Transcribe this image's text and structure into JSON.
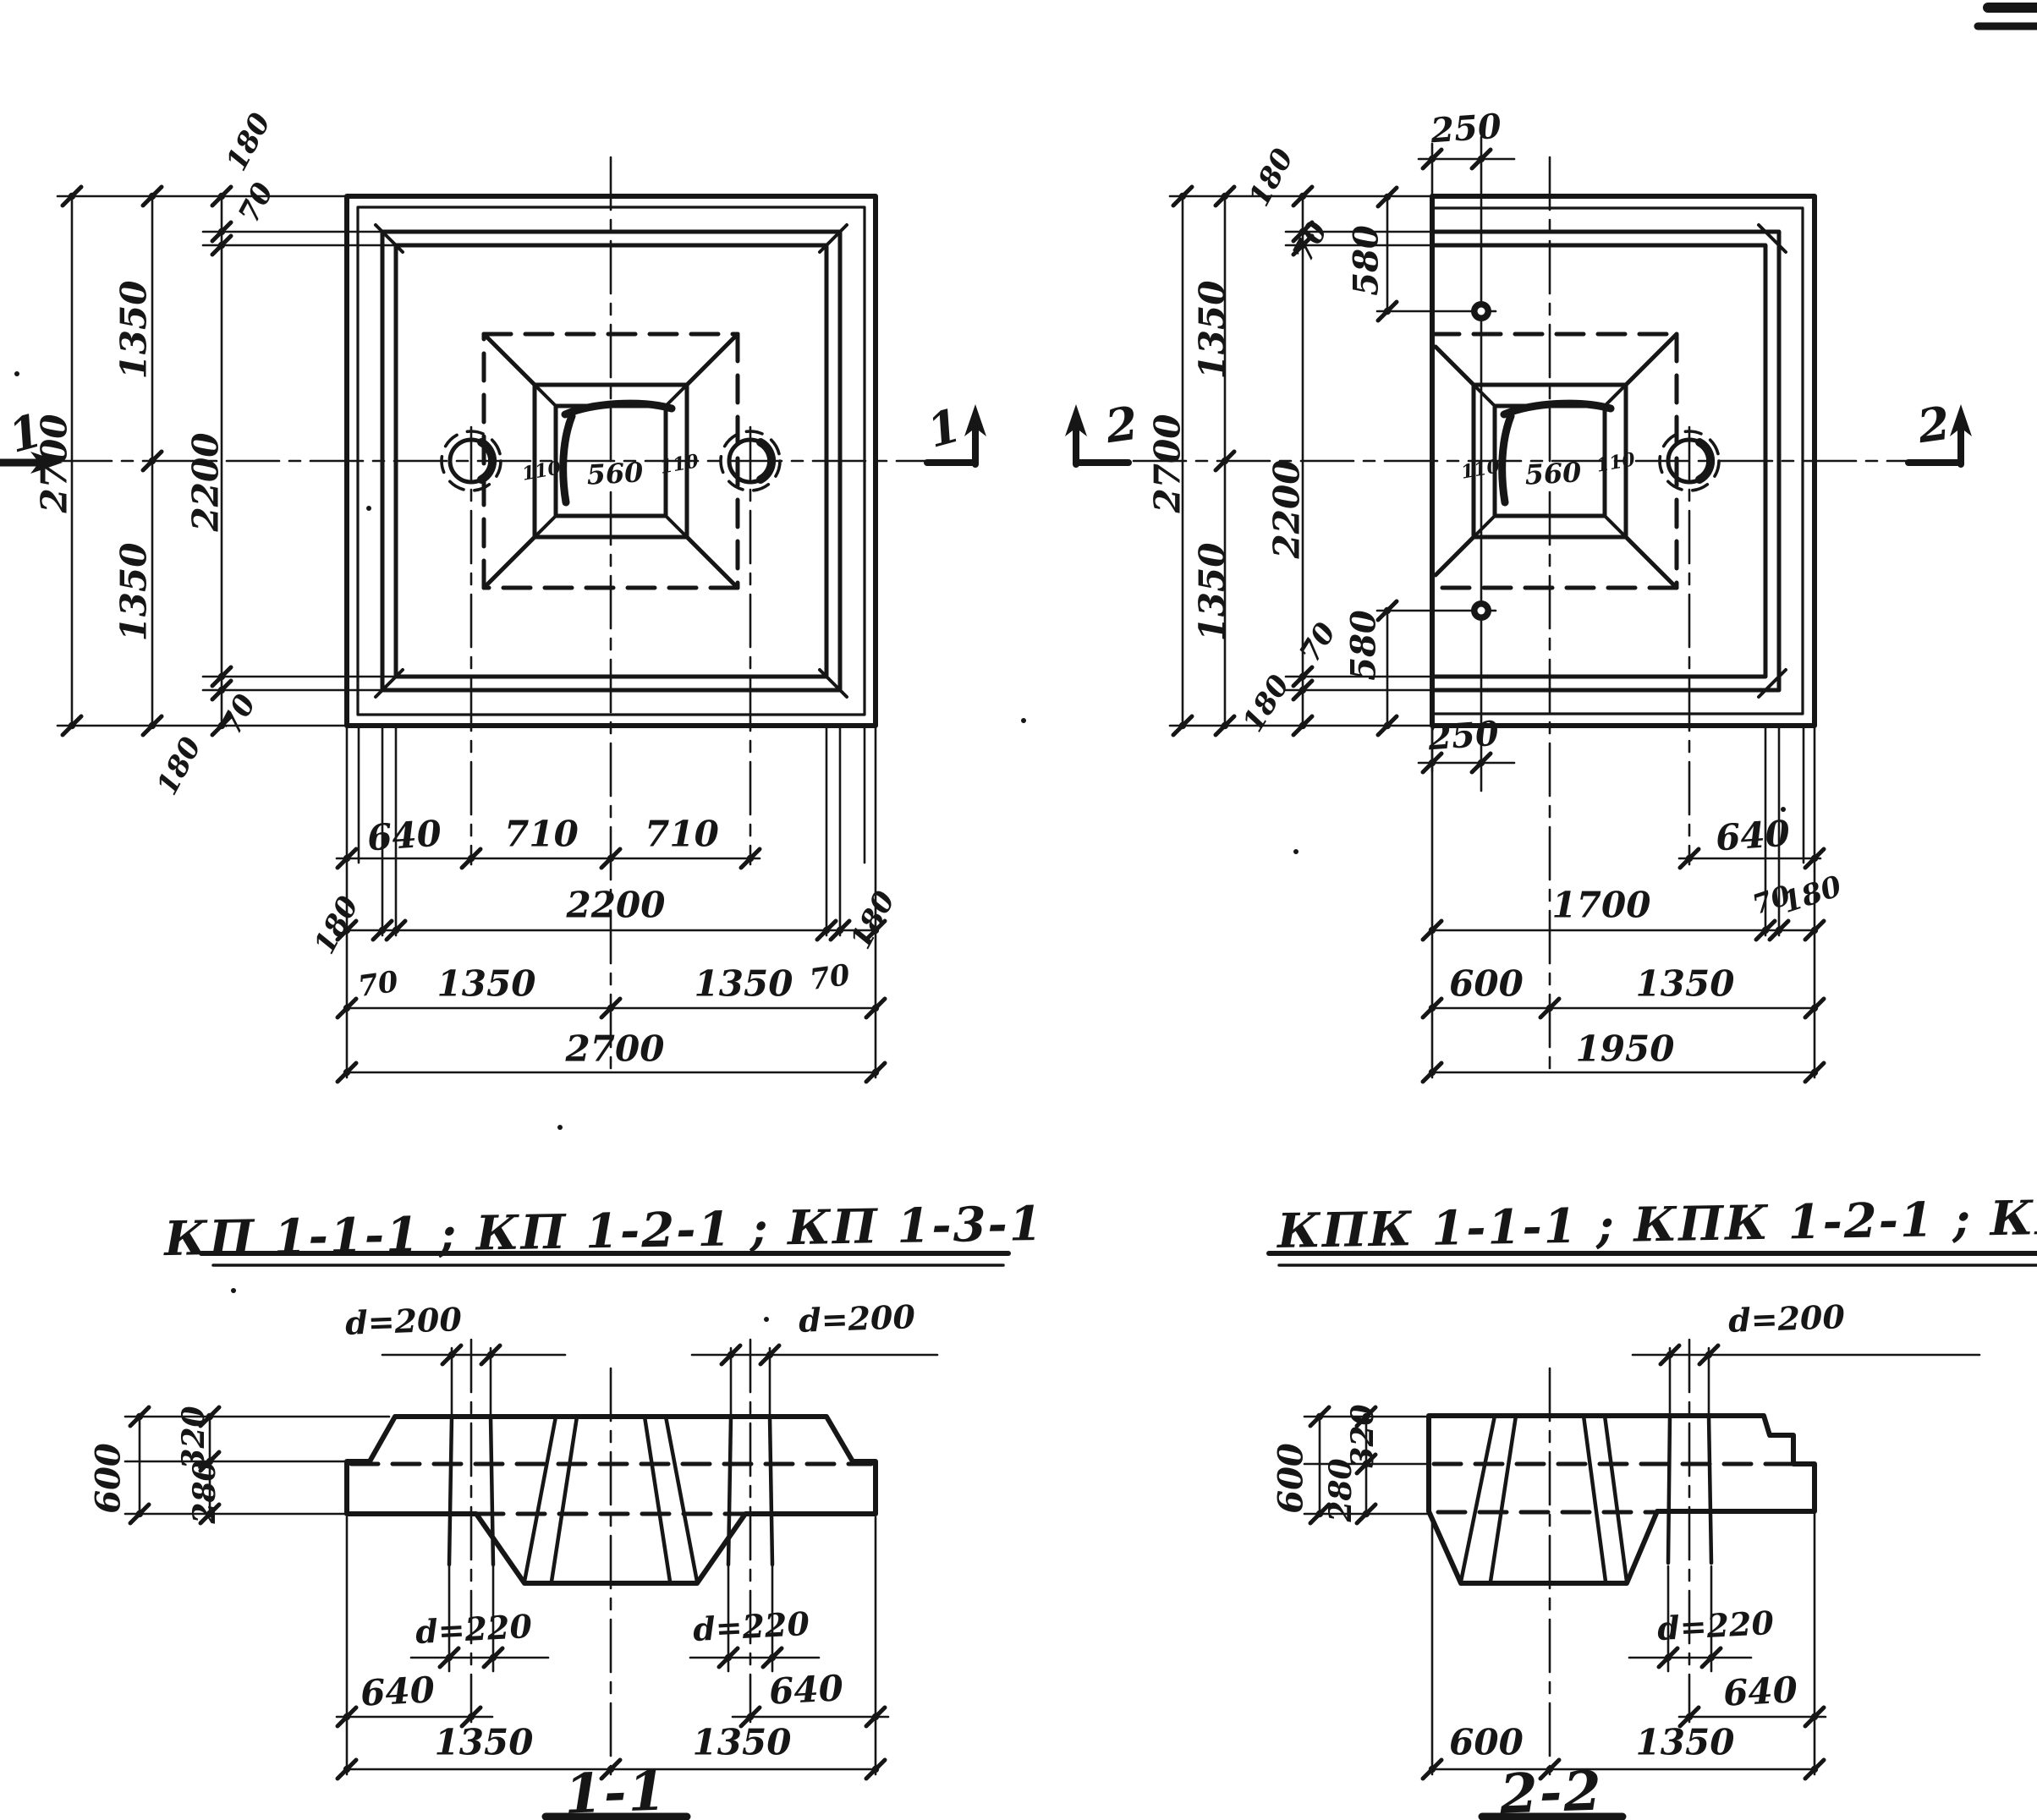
{
  "page": {
    "background": "#ffffff",
    "ink": "#161616"
  },
  "titles": {
    "plan_left_types": "КП 1-1-1 ; КП 1-2-1 ; КП 1-3-1",
    "plan_right_types": "КПК 1-1-1 ; КПК 1-2-1 ; КПК 1-3-1",
    "section_left": "1-1",
    "section_right": "2-2"
  },
  "plan_left": {
    "marker_left": "1",
    "marker_right": "1",
    "dim_2700_v": "2700",
    "dim_1350_top": "1350",
    "dim_1350_bottom": "1350",
    "dim_2200_v": "2200",
    "dim_180_top": "180",
    "dim_70_top": "70",
    "dim_70_bottom": "70",
    "dim_180_bottom": "180",
    "dim_640": "640",
    "dim_710_left": "710",
    "dim_710_right": "710",
    "dim_180_left": "180",
    "dim_2200_h": "2200",
    "dim_180_right": "180",
    "dim_70_left": "70",
    "dim_70_right": "70",
    "dim_1350_left": "1350",
    "dim_1350_right": "1350",
    "dim_2700_h": "2700",
    "socket_560": "560",
    "socket_110_left": "110",
    "socket_110_right": "110"
  },
  "plan_right": {
    "marker_left": "2",
    "marker_right": "2",
    "dim_2700_v": "2700",
    "dim_1350_top": "1350",
    "dim_1350_bottom": "1350",
    "dim_2200_v": "2200",
    "dim_180_top": "180",
    "dim_70_top": "70",
    "dim_580_top": "580",
    "dim_250_top": "250",
    "dim_70_bottom": "70",
    "dim_580_bottom": "580",
    "dim_180_bottom": "180",
    "dim_250_bottom": "250",
    "dim_640": "640",
    "dim_1700": "1700",
    "dim_70_right": "70",
    "dim_180_right": "180",
    "dim_600": "600",
    "dim_1350_h": "1350",
    "dim_1950": "1950",
    "socket_560": "560",
    "socket_110_left": "110",
    "socket_110_right": "110"
  },
  "section_1": {
    "dim_d200_left": "d=200",
    "dim_d200_right": "d=200",
    "dim_d220_left": "d=220",
    "dim_d220_right": "d=220",
    "dim_600": "600",
    "dim_320": "320",
    "dim_280": "280",
    "dim_640_left": "640",
    "dim_640_right": "640",
    "dim_1350_left": "1350",
    "dim_1350_right": "1350"
  },
  "section_2": {
    "dim_d200": "d=200",
    "dim_d220": "d=220",
    "dim_600": "600",
    "dim_320": "320",
    "dim_280": "280",
    "dim_640": "640",
    "dim_600_h": "600",
    "dim_1350": "1350"
  }
}
